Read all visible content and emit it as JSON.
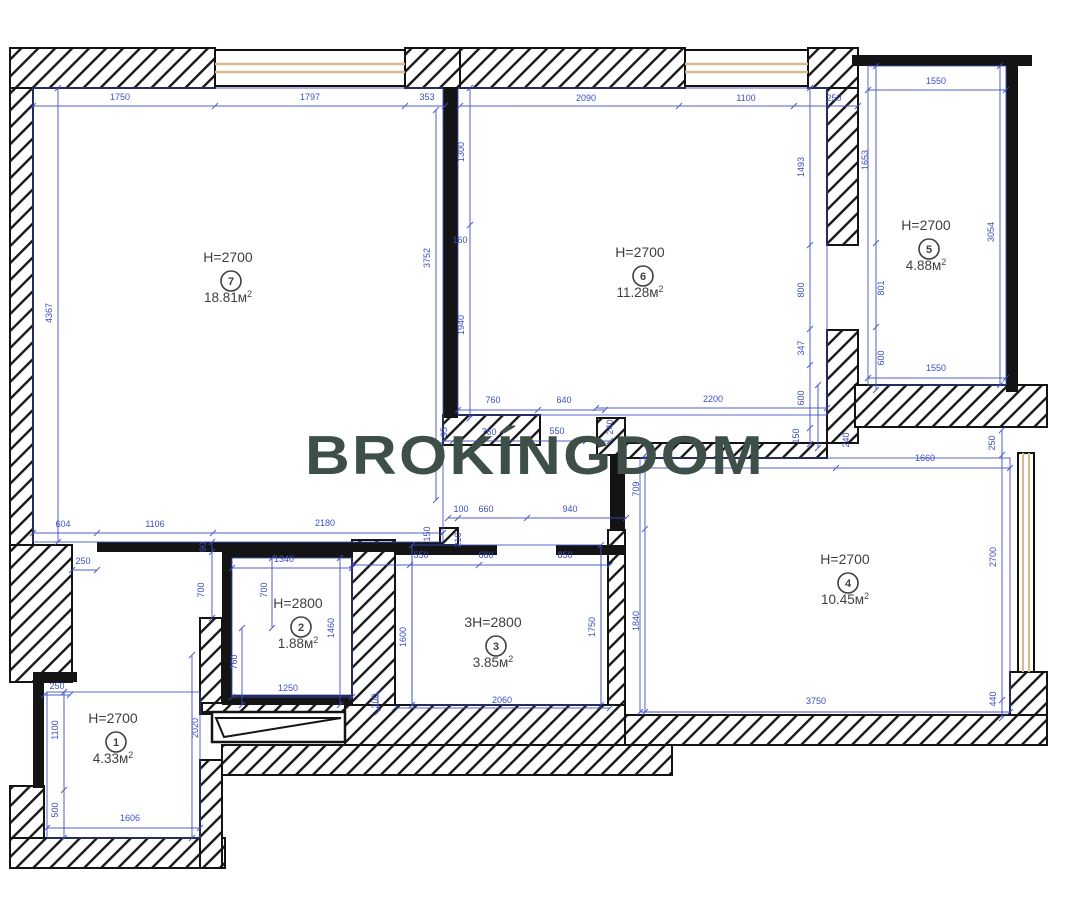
{
  "watermark": {
    "text": "BROKÍNGDOM",
    "color": "#3d4f47"
  },
  "colors": {
    "dimension": "#3c4ec2",
    "wall": "#141414",
    "window_frame": "#d9b88c",
    "room_text": "#3f3f3f"
  },
  "rooms": [
    {
      "number": "1",
      "height": "H=2700",
      "area": "4.33м²",
      "x": 113,
      "y": 723
    },
    {
      "number": "2",
      "height": "H=2800",
      "area": "1.88м²",
      "x": 298,
      "y": 608
    },
    {
      "number": "3",
      "height": "3H=2800",
      "area": "3.85м²",
      "x": 493,
      "y": 627
    },
    {
      "number": "4",
      "height": "H=2700",
      "area": "10.45м²",
      "x": 845,
      "y": 564
    },
    {
      "number": "5",
      "height": "H=2700",
      "area": "4.88м²",
      "x": 926,
      "y": 230
    },
    {
      "number": "6",
      "height": "H=2700",
      "area": "11.28м²",
      "x": 640,
      "y": 257
    },
    {
      "number": "7",
      "height": "H=2700",
      "area": "18.81м²",
      "x": 228,
      "y": 262
    }
  ],
  "dimensions": [
    {
      "t": "1750",
      "x": 120,
      "y": 100,
      "o": "h"
    },
    {
      "t": "1797",
      "x": 310,
      "y": 100,
      "o": "h"
    },
    {
      "t": "353",
      "x": 427,
      "y": 100,
      "o": "h"
    },
    {
      "t": "2090",
      "x": 586,
      "y": 101,
      "o": "h"
    },
    {
      "t": "1100",
      "x": 746,
      "y": 101,
      "o": "h"
    },
    {
      "t": "250",
      "x": 834,
      "y": 101,
      "o": "h"
    },
    {
      "t": "1550",
      "x": 936,
      "y": 84,
      "o": "h"
    },
    {
      "t": "4367",
      "x": 52,
      "y": 313,
      "o": "v"
    },
    {
      "t": "3752",
      "x": 430,
      "y": 258,
      "o": "v"
    },
    {
      "t": "1300",
      "x": 464,
      "y": 152,
      "o": "v"
    },
    {
      "t": "160",
      "x": 460,
      "y": 243,
      "o": "h"
    },
    {
      "t": "1940",
      "x": 464,
      "y": 325,
      "o": "v"
    },
    {
      "t": "1493",
      "x": 804,
      "y": 167,
      "o": "v"
    },
    {
      "t": "800",
      "x": 804,
      "y": 290,
      "o": "v"
    },
    {
      "t": "347",
      "x": 804,
      "y": 348,
      "o": "v"
    },
    {
      "t": "600",
      "x": 804,
      "y": 398,
      "o": "v"
    },
    {
      "t": "150",
      "x": 799,
      "y": 436,
      "o": "v"
    },
    {
      "t": "1653",
      "x": 868,
      "y": 160,
      "o": "v"
    },
    {
      "t": "801",
      "x": 884,
      "y": 288,
      "o": "v"
    },
    {
      "t": "600",
      "x": 884,
      "y": 358,
      "o": "v"
    },
    {
      "t": "3054",
      "x": 994,
      "y": 232,
      "o": "v"
    },
    {
      "t": "1550",
      "x": 936,
      "y": 371,
      "o": "h"
    },
    {
      "t": "240",
      "x": 849,
      "y": 440,
      "o": "v"
    },
    {
      "t": "250",
      "x": 995,
      "y": 443,
      "o": "v"
    },
    {
      "t": "1660",
      "x": 925,
      "y": 461,
      "o": "h"
    },
    {
      "t": "709",
      "x": 639,
      "y": 489,
      "o": "v"
    },
    {
      "t": "1840",
      "x": 639,
      "y": 621,
      "o": "v"
    },
    {
      "t": "2700",
      "x": 996,
      "y": 557,
      "o": "v"
    },
    {
      "t": "440",
      "x": 996,
      "y": 699,
      "o": "v"
    },
    {
      "t": "3750",
      "x": 816,
      "y": 704,
      "o": "h"
    },
    {
      "t": "760",
      "x": 493,
      "y": 403,
      "o": "h"
    },
    {
      "t": "640",
      "x": 564,
      "y": 403,
      "o": "h"
    },
    {
      "t": "95",
      "x": 447,
      "y": 432,
      "o": "v"
    },
    {
      "t": "760",
      "x": 489,
      "y": 435,
      "o": "h"
    },
    {
      "t": "550",
      "x": 557,
      "y": 434,
      "o": "h"
    },
    {
      "t": "240",
      "x": 613,
      "y": 427,
      "o": "v"
    },
    {
      "t": "2200",
      "x": 713,
      "y": 402,
      "o": "h"
    },
    {
      "t": "100",
      "x": 461,
      "y": 512,
      "o": "h"
    },
    {
      "t": "660",
      "x": 486,
      "y": 512,
      "o": "h"
    },
    {
      "t": "940",
      "x": 570,
      "y": 512,
      "o": "h"
    },
    {
      "t": "604",
      "x": 63,
      "y": 527,
      "o": "h"
    },
    {
      "t": "1106",
      "x": 155,
      "y": 527,
      "o": "h"
    },
    {
      "t": "2180",
      "x": 325,
      "y": 526,
      "o": "h"
    },
    {
      "t": "150",
      "x": 430,
      "y": 534,
      "o": "v"
    },
    {
      "t": "210",
      "x": 461,
      "y": 540,
      "o": "v"
    },
    {
      "t": "550",
      "x": 421,
      "y": 558,
      "o": "h"
    },
    {
      "t": "660",
      "x": 486,
      "y": 558,
      "o": "h"
    },
    {
      "t": "850",
      "x": 565,
      "y": 558,
      "o": "h"
    },
    {
      "t": "1340",
      "x": 284,
      "y": 562,
      "o": "h"
    },
    {
      "t": "250",
      "x": 83,
      "y": 564,
      "o": "h"
    },
    {
      "t": "90",
      "x": 206,
      "y": 547,
      "o": "v"
    },
    {
      "t": "700",
      "x": 204,
      "y": 590,
      "o": "v"
    },
    {
      "t": "700",
      "x": 267,
      "y": 590,
      "o": "v"
    },
    {
      "t": "760",
      "x": 237,
      "y": 662,
      "o": "v"
    },
    {
      "t": "1460",
      "x": 334,
      "y": 628,
      "o": "v"
    },
    {
      "t": "1600",
      "x": 406,
      "y": 637,
      "o": "v"
    },
    {
      "t": "1750",
      "x": 595,
      "y": 627,
      "o": "v"
    },
    {
      "t": "300",
      "x": 378,
      "y": 701,
      "o": "v"
    },
    {
      "t": "1250",
      "x": 288,
      "y": 691,
      "o": "h"
    },
    {
      "t": "2060",
      "x": 502,
      "y": 703,
      "o": "h"
    },
    {
      "t": "250",
      "x": 57,
      "y": 689,
      "o": "h"
    },
    {
      "t": "1100",
      "x": 58,
      "y": 730,
      "o": "v"
    },
    {
      "t": "500",
      "x": 58,
      "y": 810,
      "o": "v"
    },
    {
      "t": "1606",
      "x": 130,
      "y": 821,
      "o": "h"
    },
    {
      "t": "2020",
      "x": 198,
      "y": 728,
      "o": "v"
    }
  ]
}
